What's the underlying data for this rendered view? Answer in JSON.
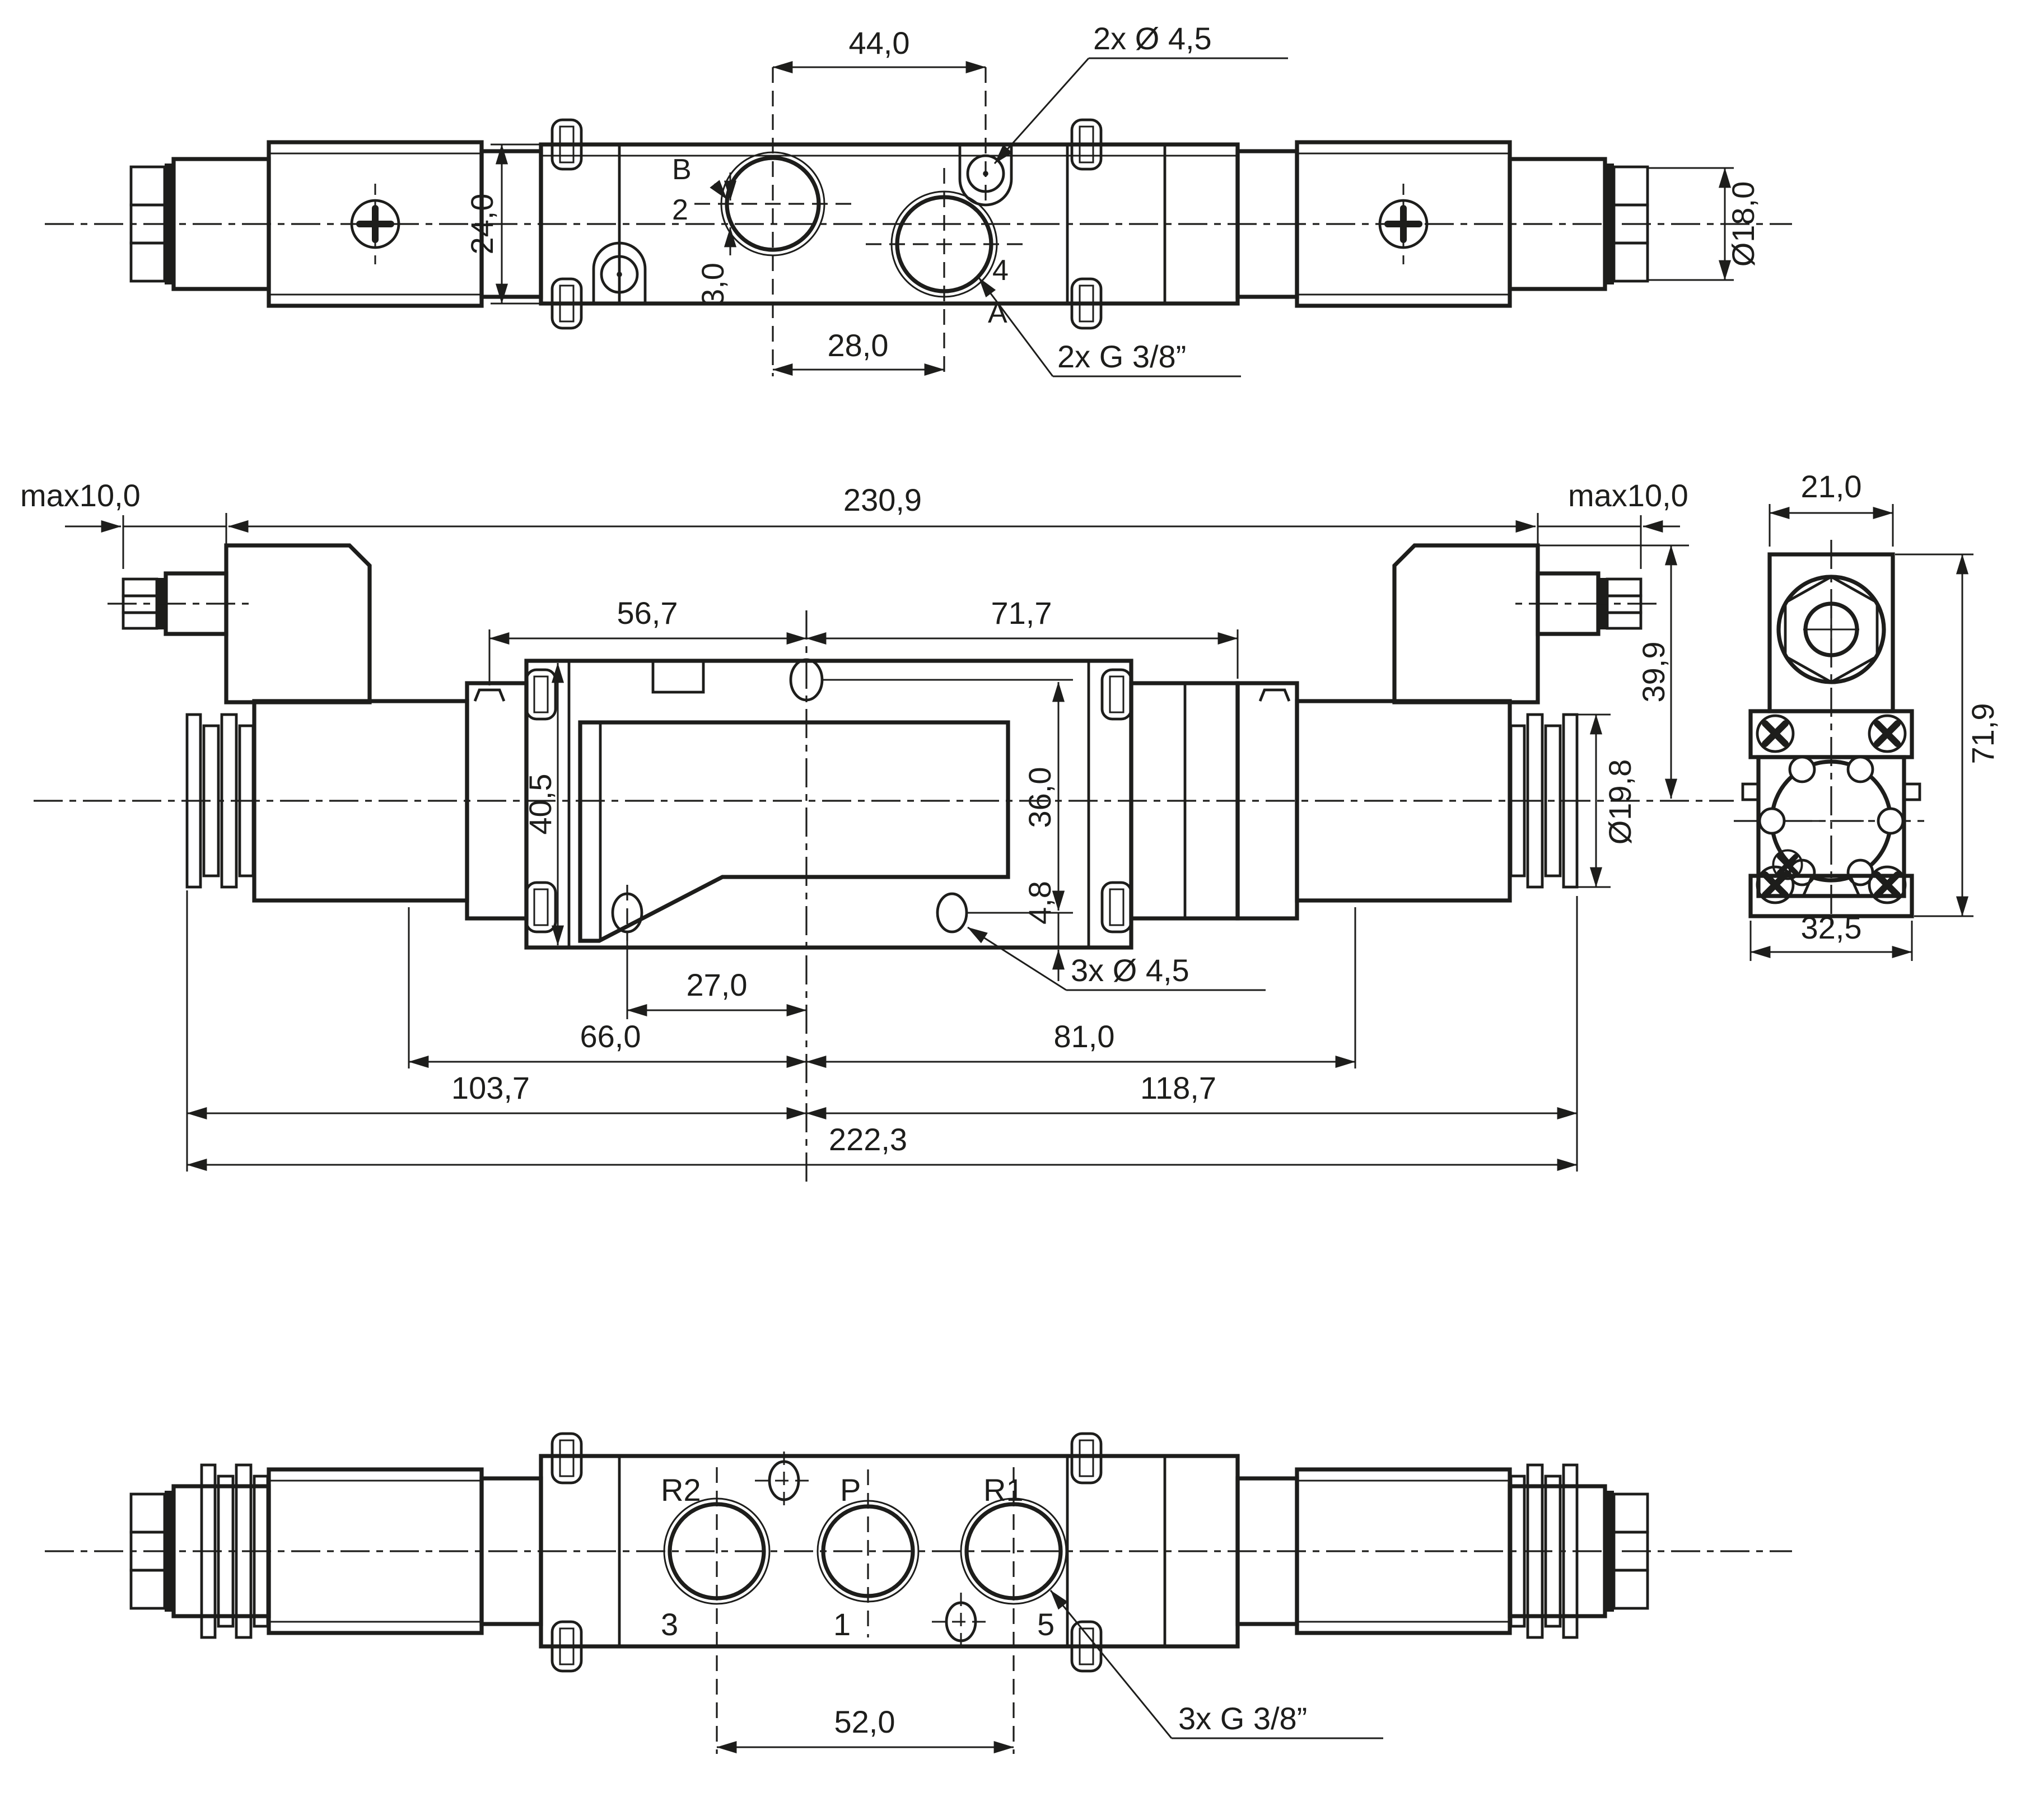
{
  "drawing": {
    "kind": "technical-dimension-drawing",
    "subject": "5/2-way solenoid pilot valve, three orthographic views",
    "colors": {
      "background": "#ffffff",
      "line": "#1d1d1b"
    },
    "views": {
      "top": {
        "dim_width": "44,0",
        "dim_holes": "2x Ø 4,5",
        "label_b": "B",
        "label_2": "2",
        "dim_height": "24,0",
        "dim_offset": "3,0",
        "dim_ports": "28,0",
        "label_4": "4",
        "label_a": "A",
        "dim_thread": "2x G 3/8”",
        "dim_gland_dia": "Ø18,0"
      },
      "front": {
        "dim_max_left": "max10,0",
        "dim_overall": "230,9",
        "dim_max_right": "max10,0",
        "dim_left_center": "56,7",
        "dim_center_right": "71,7",
        "dim_conn_height": "39,9",
        "dim_body_height": "40,5",
        "dim_hole_span": "36,0",
        "dim_hole_offset": "4,8",
        "dim_nut_dia": "Ø19,8",
        "dim_hole_center": "27,0",
        "dim_holes": "3x Ø 4,5",
        "dim_66": "66,0",
        "dim_81": "81,0",
        "dim_103": "103,7",
        "dim_118": "118,7",
        "dim_222": "222,3"
      },
      "side": {
        "dim_conn_width": "21,0",
        "dim_height": "71,9",
        "dim_width": "32,5"
      },
      "bottom": {
        "label_r2": "R2",
        "label_p": "P",
        "label_r1": "R1",
        "label_3": "3",
        "label_1": "1",
        "label_5": "5",
        "dim_ports": "52,0",
        "dim_thread": "3x G 3/8”"
      }
    }
  }
}
